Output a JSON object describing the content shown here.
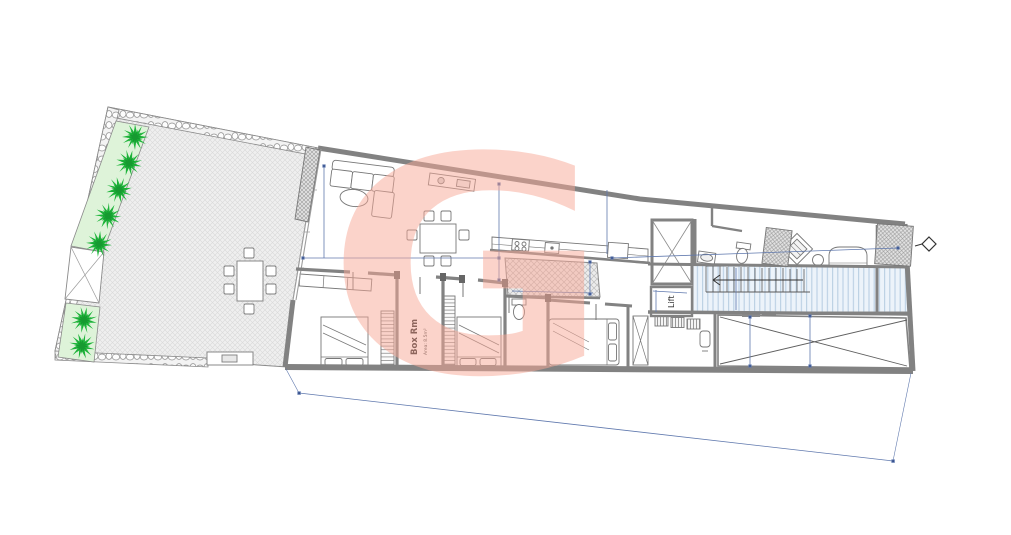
{
  "drawing": {
    "labels": {
      "lift": "Lift",
      "box_room_name": "Box Rm",
      "box_room_area": "Area: 8.5m²"
    },
    "watermark": {
      "letter": "G",
      "color": "#f7a795",
      "opacity": "0.5"
    },
    "colors": {
      "wall_gray": "#828282",
      "dimension_blue": "#6079ae",
      "plant_green": "#1db53a",
      "planter_green": "#def3d9",
      "stair_stripe_blue": "#b9cfe3",
      "paving_gray": "#efefef",
      "watermark_salmon": "#f7a795"
    }
  }
}
